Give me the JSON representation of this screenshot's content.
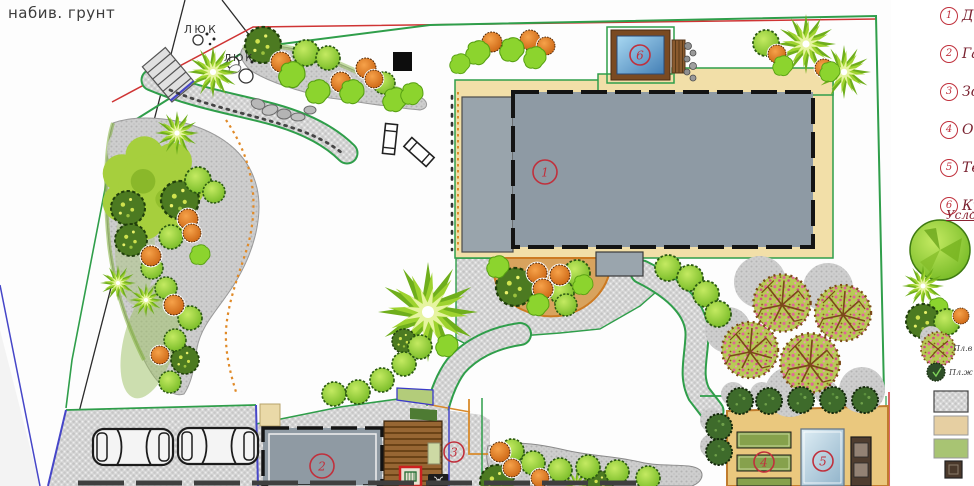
{
  "title_note": {
    "ground_note": "набив. грунт"
  },
  "plan": {
    "manhole_labels": [
      "ЛЮК",
      "ЛЮК"
    ],
    "markers": {
      "house": "1",
      "garage": "2",
      "lounge_zone": "3",
      "garden_beds": "4",
      "greenhouse": "5",
      "tub": "6"
    }
  },
  "legend": {
    "items": [
      {
        "num": "1",
        "label": "До"
      },
      {
        "num": "2",
        "label": "Га"
      },
      {
        "num": "3",
        "label": "Зо"
      },
      {
        "num": "4",
        "label": "Ог"
      },
      {
        "num": "5",
        "label": "Те"
      },
      {
        "num": "6",
        "label": "Ку"
      }
    ],
    "symbols_heading": "Усло",
    "plant_labels": {
      "fruit_tree": "Пл.в",
      "fruit_shrub": "Пл.ж"
    }
  },
  "colors": {
    "marker_red": "#c0303c",
    "fence_green": "#2f9e4a",
    "utility_red": "#cf3434",
    "boundary_blue": "#4646c8",
    "house_gray": "#8e9aa4",
    "terrace_tan": "#f2dfa8",
    "pool_blue": "#5d9fd0",
    "outbuilding_tan": "#eac87e",
    "bed_green": "#86a14c",
    "path_gray": "#d6d6d6",
    "deck_brown": "#9a6a33"
  }
}
